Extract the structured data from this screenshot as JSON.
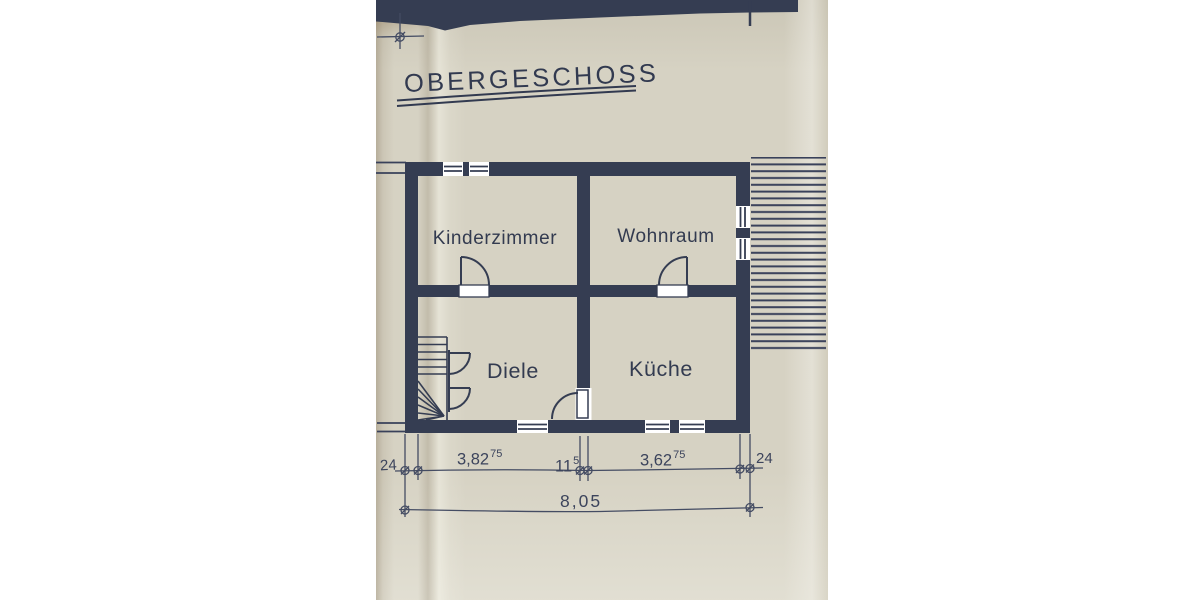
{
  "document": {
    "title": "OBERGESCHOSS",
    "floor_plan": {
      "rooms": [
        {
          "name": "Kinderzimmer"
        },
        {
          "name": "Wohnraum"
        },
        {
          "name": "Diele"
        },
        {
          "name": "Küche"
        }
      ],
      "dimensions": {
        "wall_left": "24",
        "width_left": {
          "main": "3,82",
          "sup": "75"
        },
        "wall_middle": {
          "main": "11",
          "sup": "5"
        },
        "width_right": {
          "main": "3,62",
          "sup": "75"
        },
        "wall_right": "24",
        "total_width": "8,05"
      },
      "symbols": [
        "stairs",
        "door-swing",
        "window",
        "roof-hatching"
      ]
    },
    "colors": {
      "paper": "#d6d2c3",
      "ink": "#39415a",
      "background": "#ffffff"
    }
  }
}
